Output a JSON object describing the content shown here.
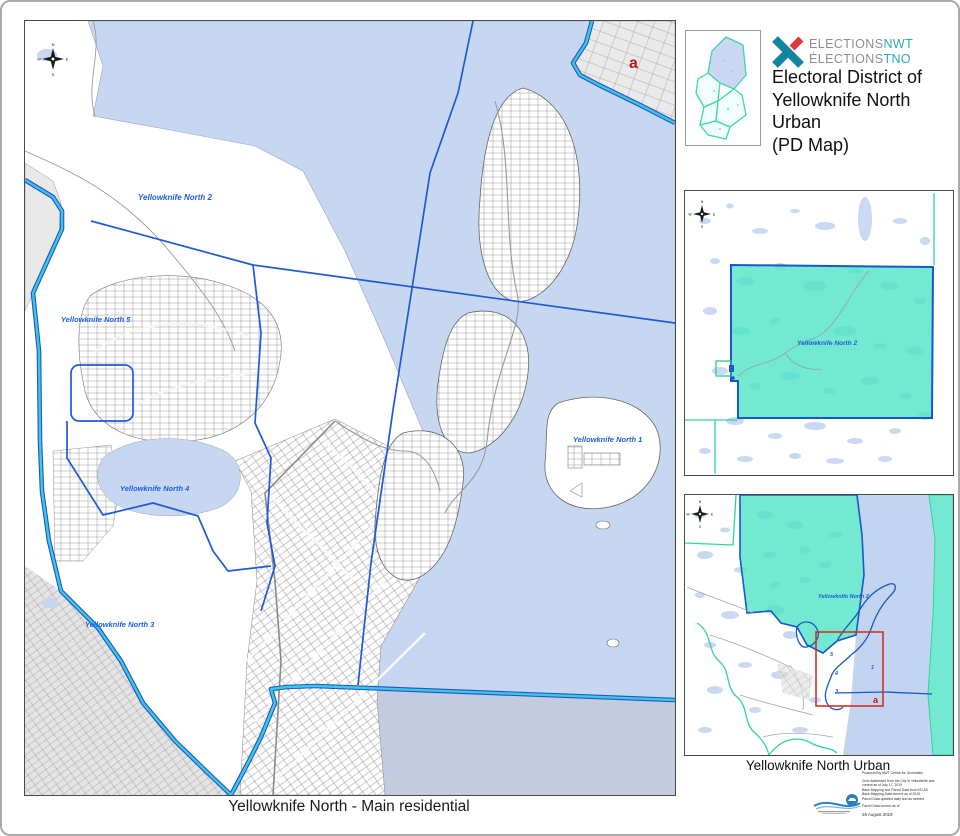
{
  "header": {
    "brand": {
      "l1_gray": "ELECTIONS",
      "l1_teal": "NWT",
      "l2_gray": "ÉLECTIONS",
      "l2_teal": "TNO"
    },
    "title": "Electoral District of\nYellowknife North\nUrban\n(PD Map)"
  },
  "compass": {
    "n": "N",
    "e": "E",
    "s": "S",
    "w": "W"
  },
  "main_map": {
    "caption": "Yellowknife North - Main residential",
    "labels": {
      "yk1": "Yellowknife North 1",
      "yk2": "Yellowknife North 2",
      "yk3": "Yellowknife North 3",
      "yk4": "Yellowknife North 4",
      "yk5": "Yellowknife North 5",
      "marker_a": "a"
    }
  },
  "inset_overview": {
    "label_yk2": "Yellowknife North 2"
  },
  "inset_urban": {
    "caption": "Yellowknife North Urban",
    "label_yk2": "Yellowknife North 2",
    "marker_a": "a",
    "pd_numbers": {
      "n1": "1",
      "n3": "3",
      "n4": "4",
      "n5": "5"
    }
  },
  "footer": {
    "credits": [
      "Produced by NWT Centre for Geomatics",
      "Civic Addresses from the City of Yellowknife and",
      "current as of July 17, 2019",
      "Base Mapping and Parcel Data from ATLAS",
      "Base Mapping Data current as of 2015",
      "Parcel Data updated daily and as needed",
      "Parcel Data current as of"
    ],
    "date": "28 August 2019"
  },
  "colors": {
    "water": "#C8D7F1",
    "water_outside_district": "#C3CBDF",
    "district_teal_fill": "#4FE3C4",
    "boundary_blue": "#1E5AD7",
    "boundary_cyan": "#3EC8DF",
    "boundary_casing": "#1D55C9",
    "green_line": "#2FD3A4",
    "label_blue": "#1D5FE0",
    "marker_red": "#C01818",
    "brand_teal": "#2AA9C0",
    "brand_gray": "#8A8F94"
  }
}
